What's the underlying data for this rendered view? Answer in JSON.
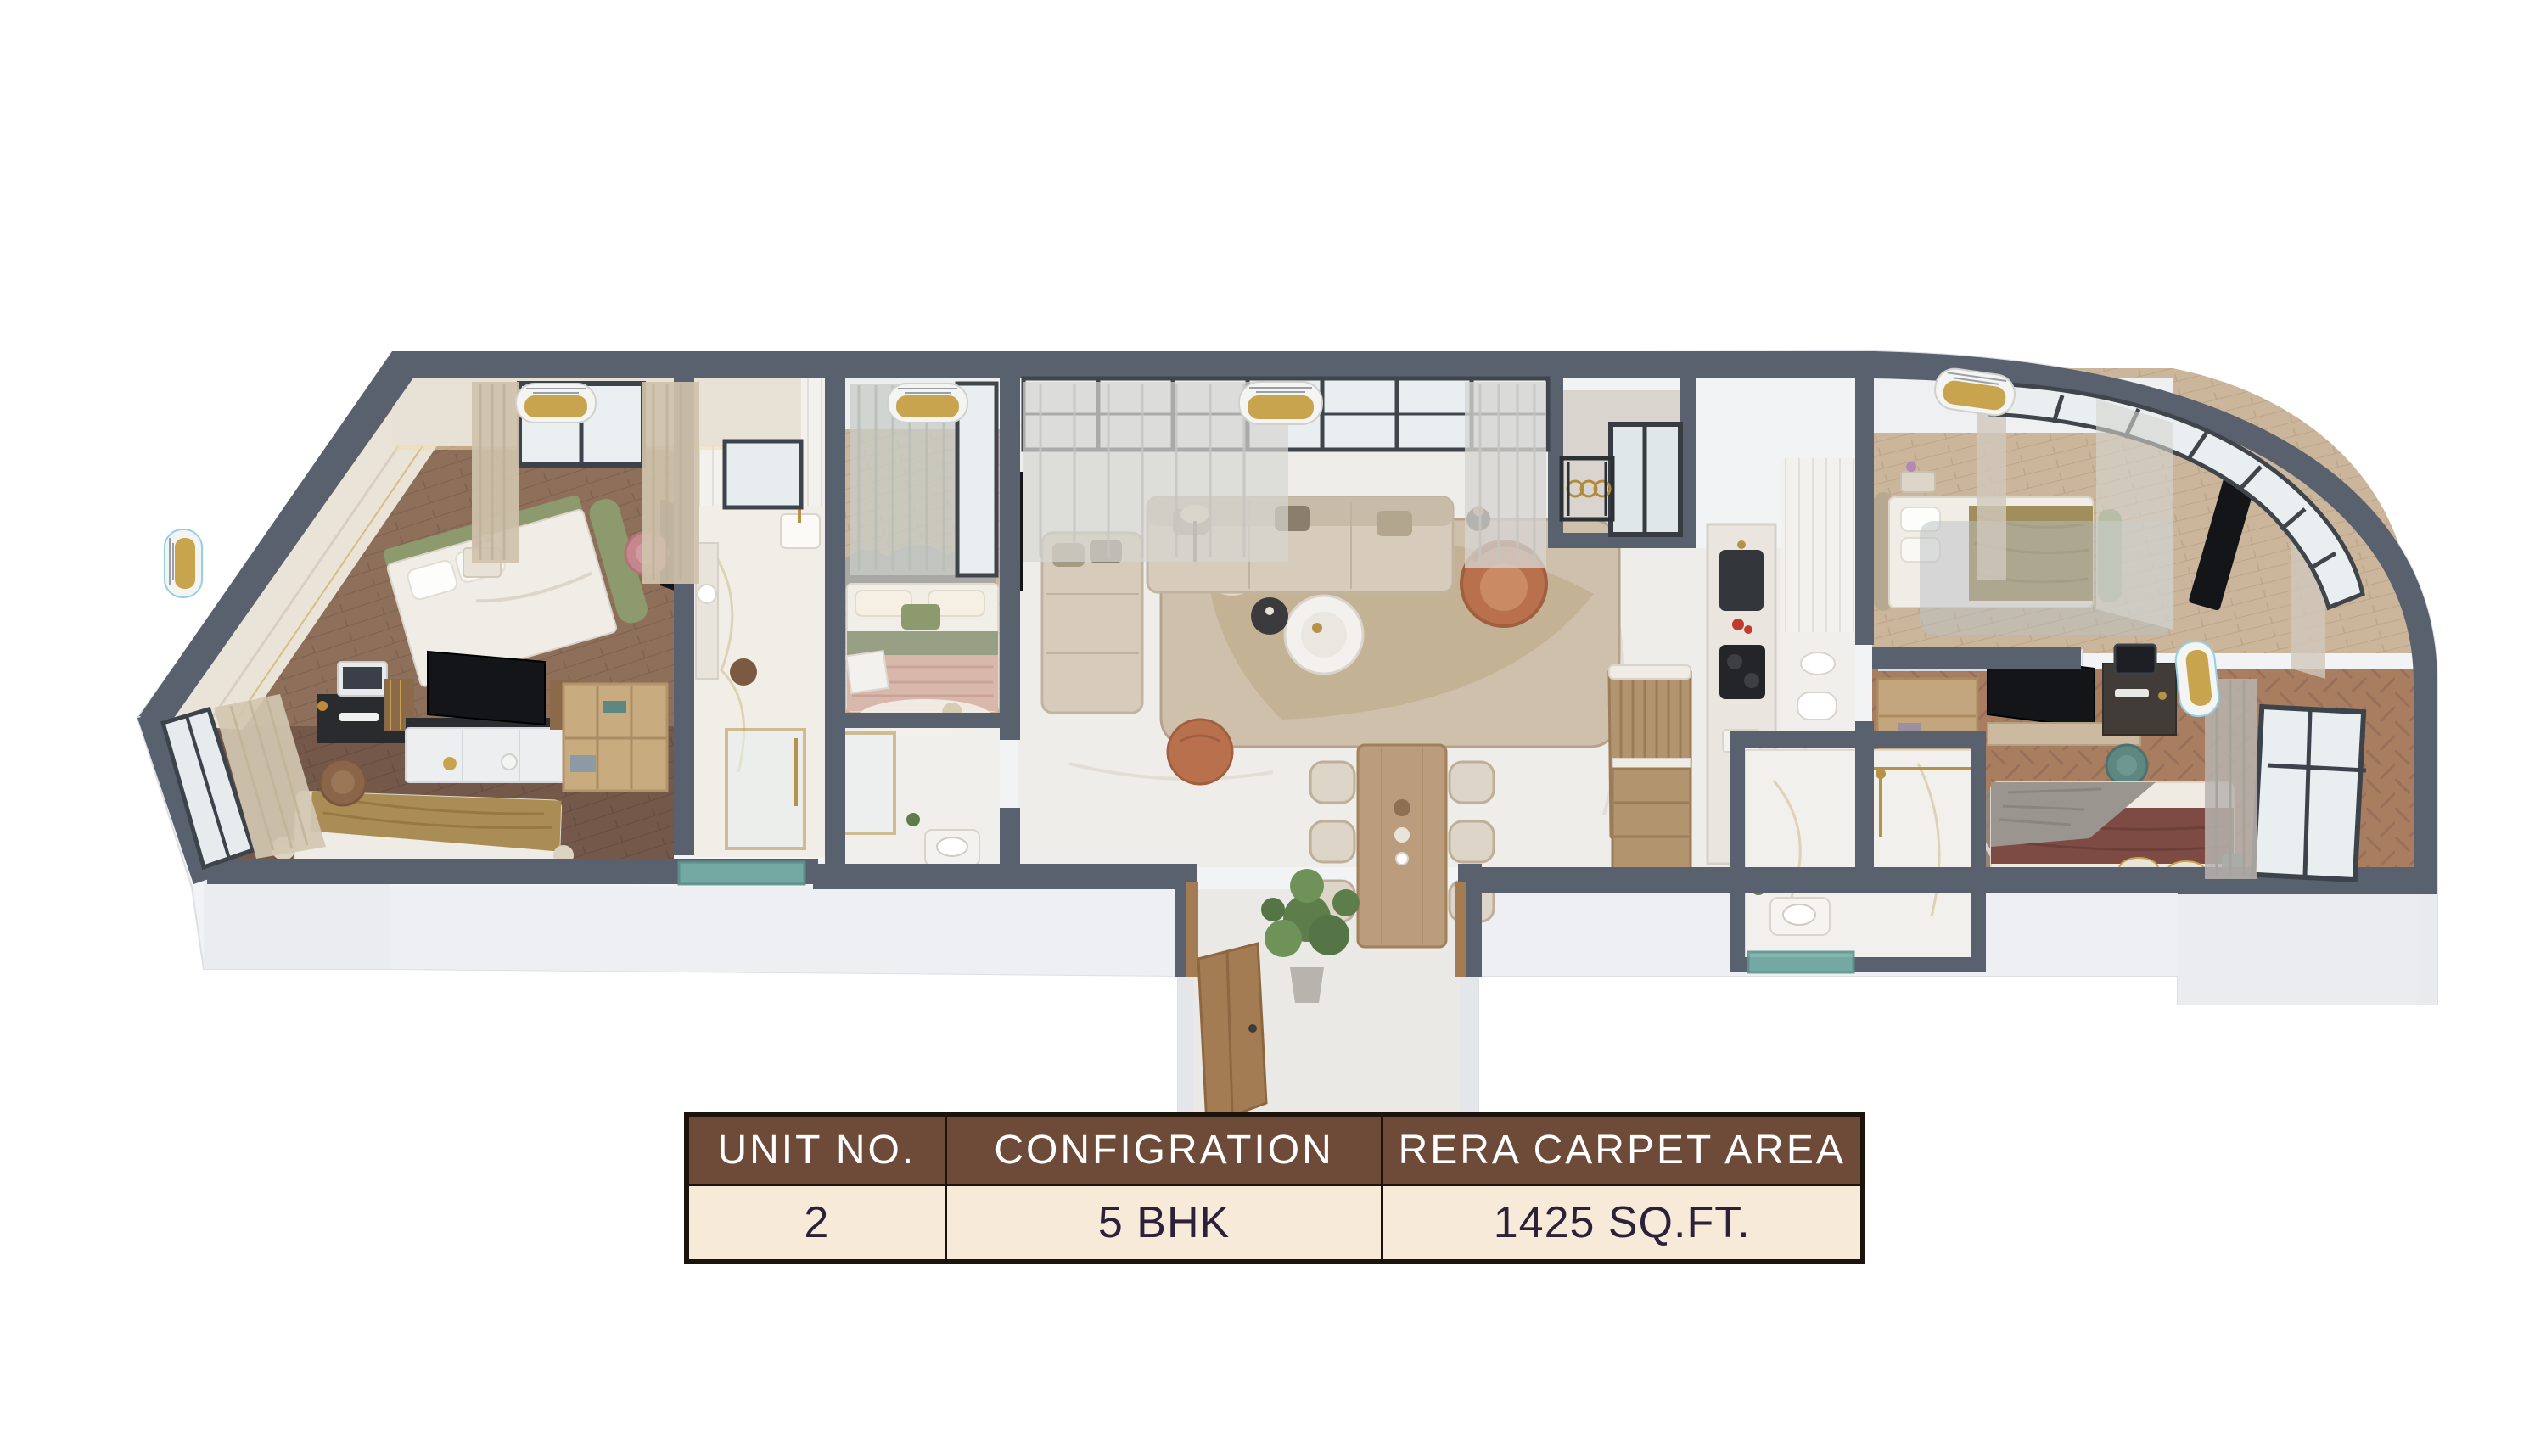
{
  "page": {
    "background_color": "#ffffff"
  },
  "floor_plan": {
    "kind": "3d-isometric-apartment-cutaway-render",
    "colors": {
      "wall_top": "#59616E",
      "wall_face": "#EEF0F3",
      "base_plinth": "#F2F3F5",
      "marble_floor": "#EFEDEA",
      "wood_floor_dark": "#74584A",
      "wood_floor_mid": "#8D6F5A",
      "wood_floor_light": "#CBB69C",
      "sofa_beige": "#D7CCBC",
      "accent_terracotta": "#B9714D",
      "accent_olive": "#8D9A6D",
      "accent_teal": "#5F8781",
      "accent_gold": "#C9A44E",
      "glass": "#E9EEF0"
    }
  },
  "unit_table": {
    "columns": [
      {
        "header": "UNIT NO.",
        "value": "2"
      },
      {
        "header": "CONFIGRATION",
        "value": "5 BHK"
      },
      {
        "header": "RERA CARPET AREA",
        "value": "1425 SQ.FT."
      }
    ],
    "style": {
      "header_bg": "#6E4A38",
      "header_text": "#FFFFFF",
      "row_bg": "#F8EAD9",
      "row_text": "#2C2138",
      "border": "#1C130D"
    }
  }
}
